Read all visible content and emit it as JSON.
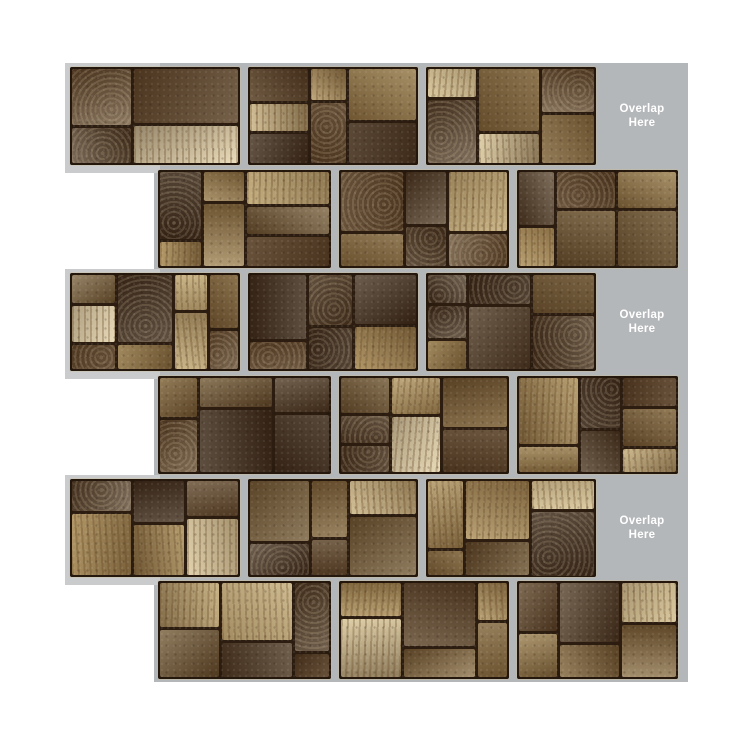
{
  "labels": {
    "overlap": {
      "line1": "Overlap",
      "line2": "Here"
    }
  },
  "sheet_info": {
    "rows": 6,
    "bricks_per_sheet": 3,
    "overlap_tab_count": 3,
    "pattern": "running-bond"
  },
  "colors": {
    "page_background": "#ffffff",
    "backing_gray": "#b4b7b9",
    "backing_gray_light": "#c9cbcc",
    "grout": "#2c1d10",
    "label_text": "#ffffff",
    "palette": [
      "#39281a",
      "#473321",
      "#573f27",
      "#68502f",
      "#7b6038",
      "#8f7344",
      "#a98c58",
      "#c0a876",
      "#d4c194",
      "#e5d6b0"
    ]
  }
}
